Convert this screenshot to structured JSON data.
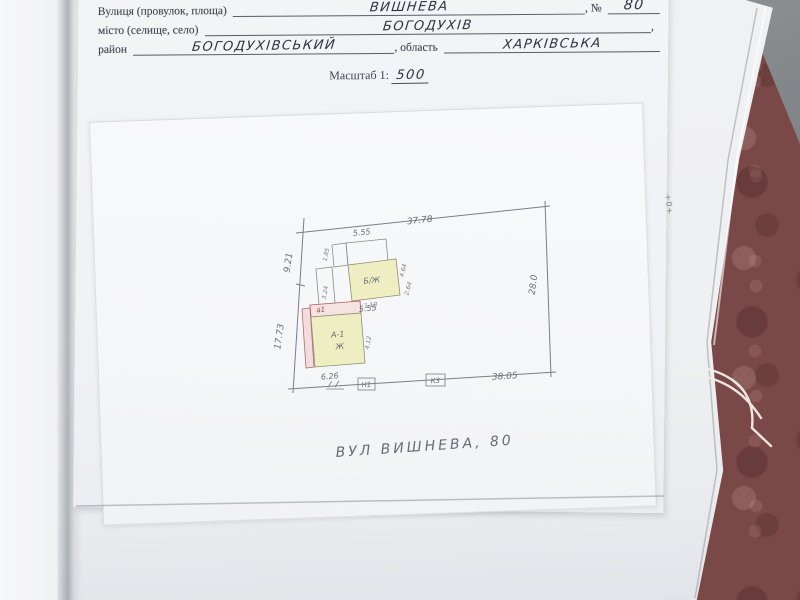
{
  "document": {
    "form": {
      "street_label": "Вулиця (провулок, площа)",
      "street_value": "ВИШНЕВА",
      "number_label": ", №",
      "number_value": "80",
      "city_label": "місто (селище, село)",
      "city_value": "БОГОДУХІВ",
      "city_suffix": ",",
      "district_label": "район",
      "district_value": "БОГОДУХІВСЬКИЙ",
      "region_label": ", область",
      "region_value": "ХАРКІВСЬКА",
      "scale_label": "Масштаб 1:",
      "scale_value": "500"
    },
    "plan": {
      "dims": {
        "top": "37.78",
        "left_upper": "9.21",
        "left_lower": "17.73",
        "right": "28.0",
        "bottom": "38.05"
      },
      "upper_building": {
        "label": "Б/Ж",
        "dim_top": "5.55",
        "dim_bottom": "5.55",
        "dim_left": "1.85",
        "dim_right_a": "4.64",
        "dim_right_b": "2.64",
        "dim_corridor": "3.24"
      },
      "lower_building": {
        "label_line1": "А-1",
        "label_line2": "Ж",
        "porch_label": "а1",
        "porch_dim": "1.10",
        "dim_right": "4.12",
        "dim_bottom": "6.26"
      },
      "fence_marks": [
        {
          "label": "Н1"
        },
        {
          "label": "К3"
        }
      ],
      "street_caption": "ВУЛ ВИШНЕВА, 80"
    },
    "edge_note": "+0+"
  },
  "colors": {
    "carpet": "#7a4846",
    "gray_shadow": "#84888b",
    "paper": "#f3f4f6",
    "building_fill": "#efeec3",
    "red_accent": "#b05858",
    "pencil": "#6a6e76",
    "ink": "#2e3340"
  }
}
